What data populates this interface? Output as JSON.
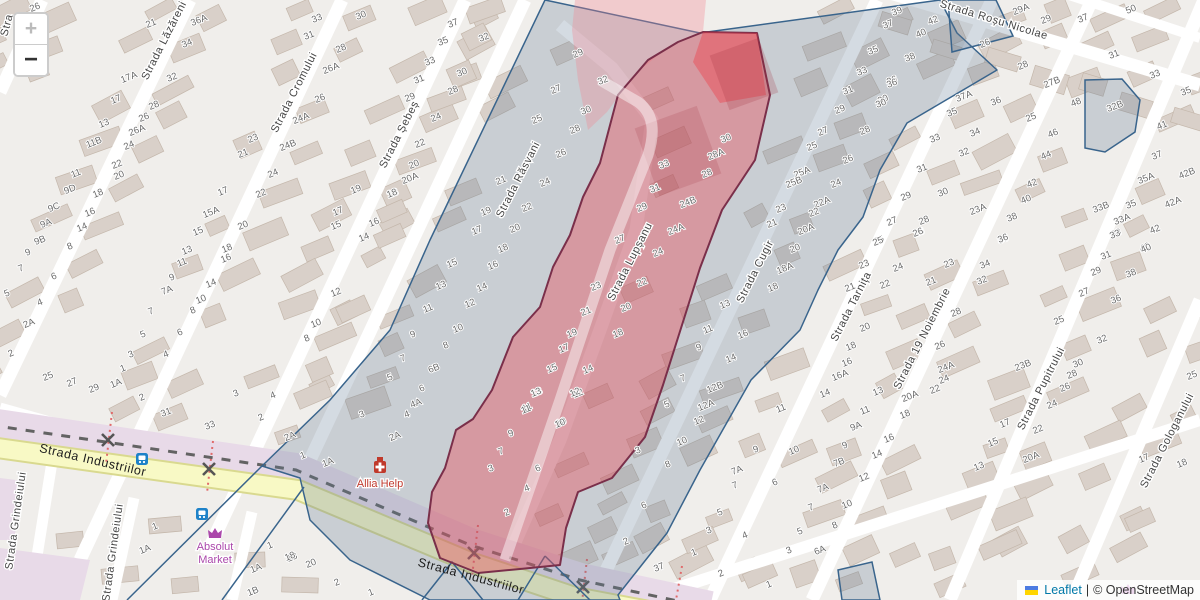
{
  "controls": {
    "zoom_in_label": "+",
    "zoom_out_label": "−"
  },
  "attribution": {
    "leaflet_label": "Leaflet",
    "separator": "|",
    "osm_label": "© OpenStreetMap",
    "flag_icon": "ukraine-flag"
  },
  "colors": {
    "background": "#f0eeeb",
    "building_fill": "#d9d0c9",
    "building_stroke": "#c4b7ab",
    "road_white": "#ffffff",
    "road_yellow_fill": "#f8f9c5",
    "road_yellow_casing": "#d9d98f",
    "railway_band": "#e8dae8",
    "rail_dash": "#636363",
    "selection_blue_stroke": "#39648c",
    "selection_blue_fill": "rgba(96,122,148,0.27)",
    "zone_red_fill": "rgba(235,75,88,0.40)",
    "zone_red_border": "#7a2f4a",
    "zone_red_tip_fill": "rgba(238,62,75,0.42)",
    "zone_pink_fill": "rgba(242,130,142,0.32)",
    "house_number_color": "#6b6b6b",
    "street_name_color": "#454545",
    "pharmacy_label_color": "#c03a2e",
    "shop_label_color": "#ab47ab",
    "bus_icon_color": "#1e82c8",
    "crossing_color": "#555555",
    "crossing_dot_color": "#e06a6a",
    "leaflet_link_color": "#0078A8"
  },
  "street_labels": [
    {
      "name": "Stra",
      "x": 10,
      "y": 26,
      "rot": -75
    },
    {
      "name": "Strada Lăzăreni",
      "x": 167,
      "y": 42,
      "rot": -63
    },
    {
      "name": "Strada Cromului",
      "x": 297,
      "y": 94,
      "rot": -63
    },
    {
      "name": "Strada Șebeș",
      "x": 402,
      "y": 136,
      "rot": -63
    },
    {
      "name": "Strada Răsvani",
      "x": 521,
      "y": 181,
      "rot": -63
    },
    {
      "name": "Strada Lupșanu",
      "x": 633,
      "y": 263,
      "rot": -63
    },
    {
      "name": "Strada Cugir",
      "x": 758,
      "y": 273,
      "rot": -63
    },
    {
      "name": "Strada Tarnița",
      "x": 854,
      "y": 308,
      "rot": -63
    },
    {
      "name": "Strada 19 Noiembrie",
      "x": 925,
      "y": 340,
      "rot": -63
    },
    {
      "name": "Strada Roșu Nicolae",
      "x": 993,
      "y": 23,
      "rot": 17
    },
    {
      "name": "Strada Pupitrului",
      "x": 1044,
      "y": 390,
      "rot": -63
    },
    {
      "name": "Strada Gologanului",
      "x": 1170,
      "y": 442,
      "rot": -63
    },
    {
      "name": "Strada Industriilor",
      "x": 92,
      "y": 464,
      "rot": 13
    },
    {
      "name": "Strada Industriilor",
      "x": 470,
      "y": 580,
      "rot": 15
    },
    {
      "name": "Strada Grindeiului",
      "x": 19,
      "y": 521,
      "rot": -82
    },
    {
      "name": "Strada Grindeiului",
      "x": 116,
      "y": 553,
      "rot": -82
    }
  ],
  "pois": [
    {
      "name": "Allia Help",
      "type": "pharmacy",
      "x": 380,
      "y": 467,
      "label_dy": 20
    },
    {
      "name": "Absolut Market",
      "type": "shop",
      "x": 215,
      "y": 534,
      "label_dy": 16,
      "two_line": true
    },
    {
      "name": "",
      "type": "shop",
      "x": 1128,
      "y": 590,
      "label_dy": 0
    }
  ],
  "bus_stops": [
    {
      "x": 142,
      "y": 459
    },
    {
      "x": 202,
      "y": 514
    }
  ],
  "level_crossings": [
    {
      "x": 108,
      "y": 440
    },
    {
      "x": 209,
      "y": 469
    },
    {
      "x": 474,
      "y": 553
    },
    {
      "x": 583,
      "y": 587
    }
  ],
  "house_numbers": [
    [
      36,
      7,
      "26"
    ],
    [
      152,
      23,
      "21"
    ],
    [
      130,
      77,
      "17A"
    ],
    [
      173,
      77,
      "32"
    ],
    [
      117,
      99,
      "17"
    ],
    [
      155,
      105,
      "28"
    ],
    [
      145,
      117,
      "26"
    ],
    [
      138,
      130,
      "26A"
    ],
    [
      105,
      123,
      "13"
    ],
    [
      95,
      142,
      "11B"
    ],
    [
      130,
      145,
      "24"
    ],
    [
      118,
      164,
      "22"
    ],
    [
      120,
      175,
      "20"
    ],
    [
      77,
      173,
      "11"
    ],
    [
      71,
      189,
      "9D"
    ],
    [
      99,
      193,
      "18"
    ],
    [
      200,
      20,
      "36A"
    ],
    [
      188,
      43,
      "34"
    ],
    [
      318,
      18,
      "33"
    ],
    [
      310,
      35,
      "31"
    ],
    [
      362,
      15,
      "30"
    ],
    [
      342,
      48,
      "28"
    ],
    [
      332,
      68,
      "26A"
    ],
    [
      321,
      98,
      "26"
    ],
    [
      302,
      118,
      "24A"
    ],
    [
      254,
      138,
      "23"
    ],
    [
      244,
      153,
      "21"
    ],
    [
      289,
      145,
      "24B"
    ],
    [
      274,
      173,
      "24"
    ],
    [
      262,
      193,
      "22"
    ],
    [
      244,
      225,
      "20"
    ],
    [
      224,
      191,
      "17"
    ],
    [
      212,
      212,
      "15A"
    ],
    [
      199,
      231,
      "15"
    ],
    [
      357,
      189,
      "19"
    ],
    [
      394,
      193,
      "18"
    ],
    [
      339,
      211,
      "17"
    ],
    [
      375,
      222,
      "16"
    ],
    [
      337,
      225,
      "15"
    ],
    [
      365,
      237,
      "14"
    ],
    [
      454,
      23,
      "37"
    ],
    [
      444,
      41,
      "35"
    ],
    [
      431,
      61,
      "33"
    ],
    [
      420,
      79,
      "31"
    ],
    [
      411,
      97,
      "29"
    ],
    [
      485,
      37,
      "32"
    ],
    [
      463,
      72,
      "30"
    ],
    [
      454,
      90,
      "28"
    ],
    [
      437,
      117,
      "24"
    ],
    [
      421,
      143,
      "22"
    ],
    [
      415,
      164,
      "20"
    ],
    [
      411,
      178,
      "20A"
    ],
    [
      393,
      193,
      "18"
    ],
    [
      579,
      53,
      "29"
    ],
    [
      557,
      89,
      "27"
    ],
    [
      538,
      119,
      "25"
    ],
    [
      502,
      180,
      "21"
    ],
    [
      487,
      211,
      "19"
    ],
    [
      478,
      230,
      "17"
    ],
    [
      604,
      80,
      "32"
    ],
    [
      587,
      110,
      "30"
    ],
    [
      576,
      129,
      "28"
    ],
    [
      562,
      153,
      "26"
    ],
    [
      546,
      182,
      "24"
    ],
    [
      528,
      207,
      "22"
    ],
    [
      516,
      228,
      "20"
    ],
    [
      504,
      248,
      "18"
    ],
    [
      665,
      164,
      "33"
    ],
    [
      656,
      188,
      "31"
    ],
    [
      643,
      207,
      "29"
    ],
    [
      621,
      239,
      "27"
    ],
    [
      597,
      286,
      "23"
    ],
    [
      587,
      311,
      "21"
    ],
    [
      573,
      333,
      "19"
    ],
    [
      565,
      348,
      "17"
    ],
    [
      553,
      368,
      "15"
    ],
    [
      538,
      392,
      "13"
    ],
    [
      528,
      407,
      "11"
    ],
    [
      727,
      138,
      "30"
    ],
    [
      717,
      154,
      "28A"
    ],
    [
      708,
      173,
      "28"
    ],
    [
      689,
      202,
      "24B"
    ],
    [
      677,
      229,
      "24A"
    ],
    [
      659,
      252,
      "24"
    ],
    [
      643,
      282,
      "22"
    ],
    [
      627,
      307,
      "20"
    ],
    [
      619,
      333,
      "18"
    ],
    [
      589,
      369,
      "14"
    ],
    [
      579,
      393,
      "12"
    ],
    [
      562,
      422,
      "10"
    ],
    [
      889,
      24,
      "37"
    ],
    [
      874,
      50,
      "35"
    ],
    [
      863,
      71,
      "33"
    ],
    [
      849,
      90,
      "31"
    ],
    [
      841,
      109,
      "29"
    ],
    [
      824,
      131,
      "27"
    ],
    [
      813,
      146,
      "25"
    ],
    [
      893,
      80,
      "36"
    ],
    [
      884,
      99,
      "30"
    ],
    [
      866,
      130,
      "28"
    ],
    [
      849,
      159,
      "26"
    ],
    [
      803,
      172,
      "25A"
    ],
    [
      795,
      182,
      "25B"
    ],
    [
      837,
      183,
      "24"
    ],
    [
      823,
      202,
      "22A"
    ],
    [
      815,
      212,
      "22"
    ],
    [
      782,
      208,
      "23"
    ],
    [
      773,
      223,
      "21"
    ],
    [
      807,
      229,
      "20A"
    ],
    [
      796,
      248,
      "20"
    ],
    [
      786,
      268,
      "18A"
    ],
    [
      774,
      287,
      "18"
    ],
    [
      726,
      304,
      "13"
    ],
    [
      709,
      329,
      "11"
    ],
    [
      700,
      347,
      "9"
    ],
    [
      744,
      334,
      "16"
    ],
    [
      732,
      358,
      "14"
    ],
    [
      684,
      378,
      "7"
    ],
    [
      716,
      387,
      "12B"
    ],
    [
      707,
      405,
      "12A"
    ],
    [
      668,
      404,
      "5"
    ],
    [
      700,
      420,
      "12"
    ],
    [
      683,
      441,
      "10"
    ],
    [
      669,
      464,
      "8"
    ],
    [
      645,
      505,
      "6"
    ],
    [
      627,
      541,
      "2"
    ],
    [
      639,
      450,
      "3"
    ],
    [
      660,
      567,
      "37"
    ],
    [
      695,
      552,
      "1"
    ],
    [
      722,
      573,
      "2"
    ],
    [
      898,
      11,
      "39"
    ],
    [
      934,
      20,
      "42"
    ],
    [
      922,
      33,
      "40"
    ],
    [
      911,
      57,
      "38"
    ],
    [
      893,
      83,
      "36"
    ],
    [
      882,
      103,
      "30"
    ],
    [
      986,
      43,
      "26"
    ],
    [
      1022,
      9,
      "29A"
    ],
    [
      1047,
      19,
      "29"
    ],
    [
      1084,
      18,
      "37"
    ],
    [
      1132,
      9,
      "50"
    ],
    [
      1115,
      54,
      "31"
    ],
    [
      1156,
      74,
      "33"
    ],
    [
      1187,
      91,
      "35"
    ],
    [
      1024,
      65,
      "28"
    ],
    [
      1053,
      82,
      "27B"
    ],
    [
      997,
      101,
      "36"
    ],
    [
      1032,
      117,
      "25"
    ],
    [
      1077,
      102,
      "48"
    ],
    [
      1054,
      133,
      "46"
    ],
    [
      1047,
      155,
      "44"
    ],
    [
      1033,
      183,
      "42"
    ],
    [
      1027,
      199,
      "40"
    ],
    [
      1013,
      217,
      "38"
    ],
    [
      1004,
      239,
      "36"
    ],
    [
      965,
      96,
      "37A"
    ],
    [
      953,
      112,
      "35"
    ],
    [
      976,
      132,
      "34"
    ],
    [
      936,
      138,
      "33"
    ],
    [
      965,
      152,
      "32"
    ],
    [
      923,
      168,
      "31"
    ],
    [
      944,
      192,
      "30"
    ],
    [
      907,
      196,
      "29"
    ],
    [
      979,
      209,
      "23A"
    ],
    [
      925,
      220,
      "28"
    ],
    [
      893,
      221,
      "27"
    ],
    [
      920,
      232,
      "26"
    ],
    [
      880,
      240,
      "25"
    ],
    [
      1116,
      106,
      "32B"
    ],
    [
      1163,
      125,
      "41"
    ],
    [
      1158,
      155,
      "37"
    ],
    [
      1147,
      178,
      "35A"
    ],
    [
      1188,
      173,
      "42B"
    ],
    [
      1174,
      202,
      "42A"
    ],
    [
      1102,
      207,
      "33B"
    ],
    [
      1132,
      204,
      "35"
    ],
    [
      1123,
      219,
      "33A"
    ],
    [
      1117,
      233,
      "33"
    ],
    [
      1156,
      229,
      "42"
    ],
    [
      1146,
      247,
      "40"
    ],
    [
      879,
      241,
      "25"
    ],
    [
      865,
      264,
      "23"
    ],
    [
      851,
      287,
      "21"
    ],
    [
      866,
      327,
      "20"
    ],
    [
      852,
      346,
      "18"
    ],
    [
      848,
      362,
      "16"
    ],
    [
      841,
      375,
      "16A"
    ],
    [
      826,
      393,
      "14"
    ],
    [
      879,
      391,
      "13"
    ],
    [
      866,
      410,
      "11"
    ],
    [
      857,
      426,
      "9A"
    ],
    [
      846,
      445,
      "9"
    ],
    [
      840,
      462,
      "7B"
    ],
    [
      919,
      232,
      "26"
    ],
    [
      899,
      267,
      "24"
    ],
    [
      886,
      284,
      "22"
    ],
    [
      932,
      281,
      "21"
    ],
    [
      950,
      263,
      "23"
    ],
    [
      957,
      312,
      "28"
    ],
    [
      941,
      345,
      "26"
    ],
    [
      947,
      367,
      "24A"
    ],
    [
      945,
      379,
      "24"
    ],
    [
      936,
      389,
      "22"
    ],
    [
      911,
      396,
      "20A"
    ],
    [
      906,
      414,
      "18"
    ],
    [
      890,
      438,
      "16"
    ],
    [
      878,
      454,
      "14"
    ],
    [
      865,
      477,
      "12"
    ],
    [
      848,
      504,
      "10"
    ],
    [
      1004,
      238,
      "36"
    ],
    [
      986,
      264,
      "34"
    ],
    [
      983,
      280,
      "32"
    ],
    [
      1116,
      234,
      "33"
    ],
    [
      1107,
      255,
      "31"
    ],
    [
      1097,
      271,
      "29"
    ],
    [
      1085,
      292,
      "27"
    ],
    [
      1060,
      320,
      "25"
    ],
    [
      1024,
      365,
      "23B"
    ],
    [
      1079,
      363,
      "30"
    ],
    [
      1073,
      374,
      "28"
    ],
    [
      1066,
      387,
      "26"
    ],
    [
      1053,
      404,
      "24"
    ],
    [
      1039,
      429,
      "22"
    ],
    [
      1032,
      457,
      "20A"
    ],
    [
      1006,
      423,
      "17"
    ],
    [
      994,
      442,
      "15"
    ],
    [
      980,
      466,
      "13"
    ],
    [
      1145,
      458,
      "17"
    ],
    [
      1183,
      463,
      "18"
    ],
    [
      1193,
      375,
      "25"
    ],
    [
      1147,
      248,
      "40"
    ],
    [
      1132,
      273,
      "38"
    ],
    [
      1117,
      299,
      "36"
    ],
    [
      1103,
      339,
      "32"
    ],
    [
      782,
      408,
      "11"
    ],
    [
      757,
      449,
      "9"
    ],
    [
      738,
      470,
      "7A"
    ],
    [
      736,
      485,
      "7"
    ],
    [
      721,
      512,
      "5"
    ],
    [
      710,
      530,
      "3"
    ],
    [
      746,
      535,
      "4"
    ],
    [
      776,
      482,
      "6"
    ],
    [
      795,
      450,
      "10"
    ],
    [
      770,
      584,
      "1"
    ],
    [
      836,
      525,
      "8"
    ],
    [
      824,
      488,
      "7A"
    ],
    [
      812,
      507,
      "7"
    ],
    [
      801,
      531,
      "5"
    ],
    [
      790,
      550,
      "3"
    ],
    [
      821,
      550,
      "6A"
    ],
    [
      55,
      207,
      "9C"
    ],
    [
      47,
      223,
      "9A"
    ],
    [
      41,
      240,
      "9B"
    ],
    [
      29,
      252,
      "9"
    ],
    [
      22,
      268,
      "7"
    ],
    [
      8,
      293,
      "5"
    ],
    [
      41,
      302,
      "4"
    ],
    [
      30,
      323,
      "2A"
    ],
    [
      12,
      353,
      "2"
    ],
    [
      91,
      212,
      "16"
    ],
    [
      83,
      227,
      "14"
    ],
    [
      71,
      246,
      "8"
    ],
    [
      55,
      276,
      "6"
    ],
    [
      188,
      250,
      "13"
    ],
    [
      183,
      262,
      "11"
    ],
    [
      173,
      277,
      "9"
    ],
    [
      168,
      290,
      "7A"
    ],
    [
      152,
      311,
      "7"
    ],
    [
      144,
      334,
      "5"
    ],
    [
      132,
      354,
      "3"
    ],
    [
      124,
      368,
      "1"
    ],
    [
      117,
      383,
      "1A"
    ],
    [
      49,
      376,
      "25"
    ],
    [
      73,
      382,
      "27"
    ],
    [
      95,
      388,
      "29"
    ],
    [
      228,
      248,
      "18"
    ],
    [
      227,
      258,
      "16"
    ],
    [
      212,
      283,
      "14"
    ],
    [
      202,
      299,
      "10"
    ],
    [
      194,
      310,
      "8"
    ],
    [
      181,
      332,
      "6"
    ],
    [
      167,
      354,
      "4"
    ],
    [
      337,
      292,
      "12"
    ],
    [
      317,
      323,
      "10"
    ],
    [
      308,
      338,
      "8"
    ],
    [
      453,
      263,
      "15"
    ],
    [
      442,
      285,
      "13"
    ],
    [
      429,
      308,
      "11"
    ],
    [
      414,
      334,
      "9"
    ],
    [
      404,
      358,
      "7"
    ],
    [
      391,
      377,
      "5"
    ],
    [
      494,
      265,
      "16"
    ],
    [
      483,
      287,
      "14"
    ],
    [
      471,
      303,
      "12"
    ],
    [
      459,
      328,
      "10"
    ],
    [
      447,
      345,
      "8"
    ],
    [
      435,
      368,
      "6B"
    ],
    [
      423,
      388,
      "6"
    ],
    [
      417,
      403,
      "4A"
    ],
    [
      408,
      414,
      "4"
    ],
    [
      363,
      414,
      "3"
    ],
    [
      143,
      397,
      "2"
    ],
    [
      167,
      412,
      "31"
    ],
    [
      211,
      425,
      "33"
    ],
    [
      237,
      393,
      "3"
    ],
    [
      274,
      395,
      "4"
    ],
    [
      262,
      417,
      "2"
    ],
    [
      291,
      436,
      "2A"
    ],
    [
      396,
      436,
      "2A"
    ],
    [
      304,
      455,
      "1"
    ],
    [
      329,
      462,
      "1A"
    ],
    [
      537,
      392,
      "13"
    ],
    [
      527,
      409,
      "11"
    ],
    [
      512,
      433,
      "9"
    ],
    [
      502,
      451,
      "7"
    ],
    [
      492,
      468,
      "3"
    ],
    [
      576,
      392,
      "12"
    ],
    [
      561,
      423,
      "10"
    ],
    [
      539,
      468,
      "6"
    ],
    [
      528,
      488,
      "4"
    ],
    [
      508,
      512,
      "2"
    ],
    [
      293,
      557,
      "18"
    ],
    [
      312,
      563,
      "20"
    ],
    [
      338,
      582,
      "2"
    ],
    [
      372,
      592,
      "1"
    ],
    [
      156,
      526,
      "1"
    ],
    [
      146,
      549,
      "1A"
    ],
    [
      257,
      568,
      "1A"
    ],
    [
      254,
      591,
      "1B"
    ],
    [
      271,
      545,
      "1"
    ],
    [
      291,
      556,
      "18"
    ]
  ]
}
